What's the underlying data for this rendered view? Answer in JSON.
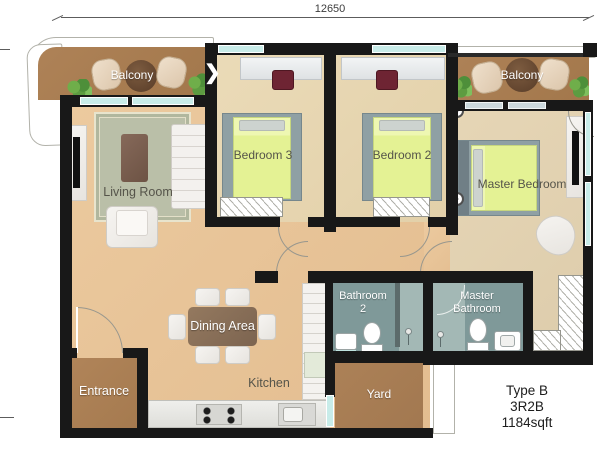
{
  "dimension": {
    "width_label": "12650"
  },
  "rooms": {
    "balcony_left": "Balcony",
    "balcony_right": "Balcony",
    "living": "Living Room",
    "bedroom3": "Bedroom 3",
    "bedroom2": "Bedroom 2",
    "master_bedroom": "Master Bedroom",
    "dining": "Dining Area",
    "kitchen": "Kitchen",
    "entrance": "Entrance",
    "yard": "Yard",
    "bathroom2_line1": "Bathroom",
    "bathroom2_line2": "2",
    "master_bathroom_line1": "Master",
    "master_bathroom_line2": "Bathroom"
  },
  "unit": {
    "type": "Type B",
    "layout": "3R2B",
    "area": "1184sqft"
  },
  "icons": {
    "balcony_door_chevron": "❯"
  },
  "colors": {
    "wall": "#181818",
    "floor_living": "#eac8a2",
    "floor_bedroom": "#e9d9b6",
    "floor_master": "#e3d3b3",
    "floor_balcony": "#aa7e52",
    "floor_entrance": "#ad8258",
    "floor_yard": "#aa8056",
    "floor_bathroom": "#7f9999",
    "window": "#c8ece9",
    "bed": "#e4f294",
    "desk_chair": "#6e2433",
    "rug": "#babfa8"
  }
}
